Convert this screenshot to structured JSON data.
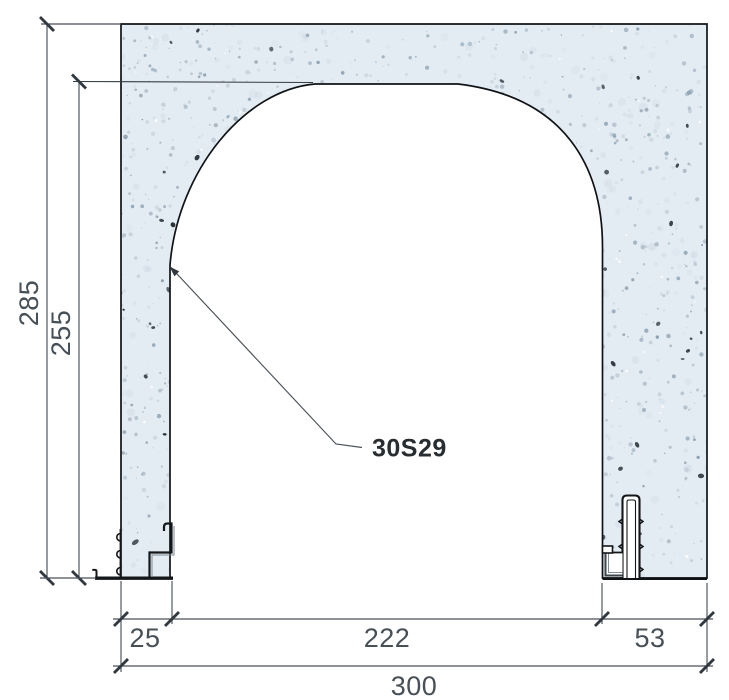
{
  "drawing": {
    "label": {
      "text": "30S29"
    },
    "dimensions": {
      "overall_height": "285",
      "opening_height": "255",
      "left_offset": "25",
      "opening_width": "222",
      "right_offset": "53",
      "overall_width": "300"
    },
    "colors": {
      "wall_fill": "#e4ecf3",
      "speckle_light": "#a9bac7",
      "speckle_dark": "#39424b",
      "outline": "#101316",
      "dimension": "#4a525a",
      "text": "#474f57",
      "label_text": "#282d32"
    }
  }
}
